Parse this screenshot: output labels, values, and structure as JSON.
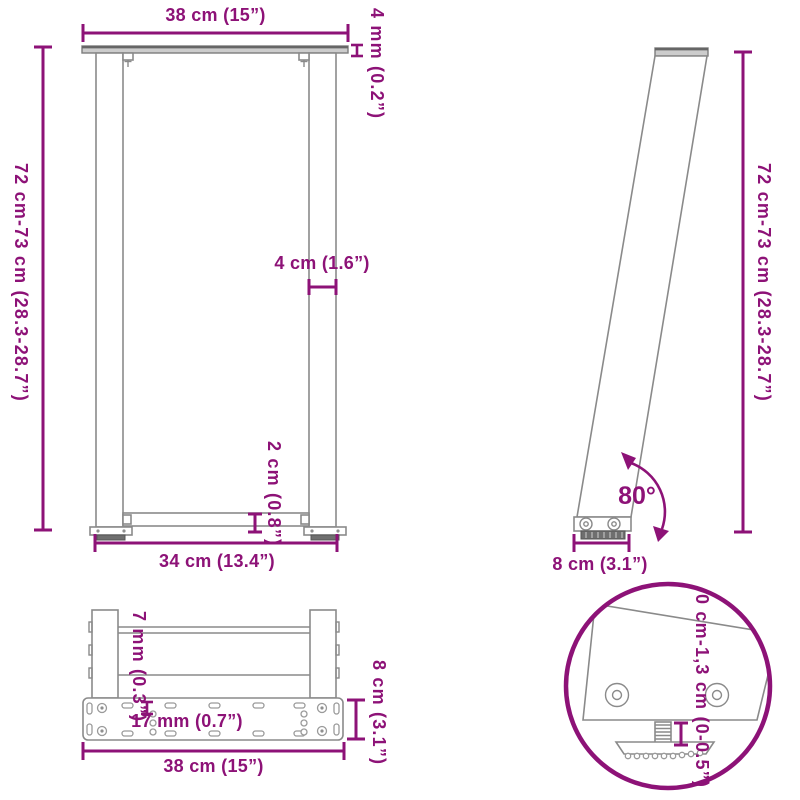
{
  "colors": {
    "accent": "#8D1277",
    "line": "#8A8A8A"
  },
  "diagram_title": "U-shaped table legs dimension diagram",
  "views": {
    "front": {
      "top_width": "38 cm (15”)",
      "plate_thickness": "4 mm (0.2”)",
      "height_range": "72 cm-73 cm (28.3-28.7”)",
      "leg_width": "4 cm (1.6”)",
      "crossbar_width": "2 cm (0.8”)",
      "bottom_width": "34 cm (13.4”)"
    },
    "side": {
      "height_range": "72 cm-73 cm (28.3-28.7”)",
      "leg_angle": "80°",
      "foot_depth": "8 cm (3.1”)"
    },
    "bottom": {
      "profile_thickness": "7 mm (0.3”)",
      "hole_spacing": "17 mm (0.7”)",
      "plate_depth": "8 cm (3.1”)",
      "plate_width": "38 cm (15”)"
    },
    "detail": {
      "adjustable_range": "0 cm-1,3 cm (0-0.5”)"
    }
  }
}
